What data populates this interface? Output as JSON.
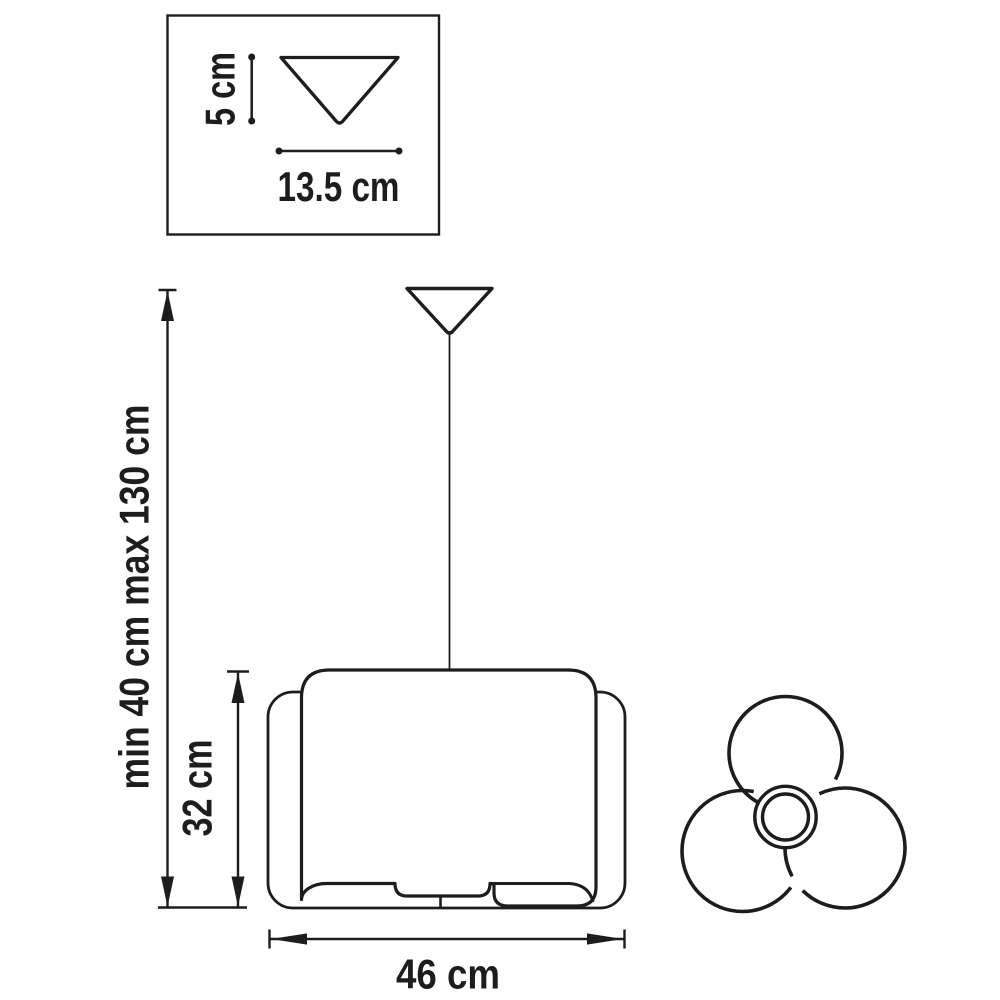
{
  "colors": {
    "line": "#1d1d1b",
    "background": "#ffffff"
  },
  "inset": {
    "cone_height_label": "5 cm",
    "cone_diameter_label": "13.5 cm"
  },
  "front_view": {
    "suspension_range_label": "min 40 cm max 130 cm",
    "shade_height_label": "32 cm",
    "shade_width_label": "46 cm"
  }
}
